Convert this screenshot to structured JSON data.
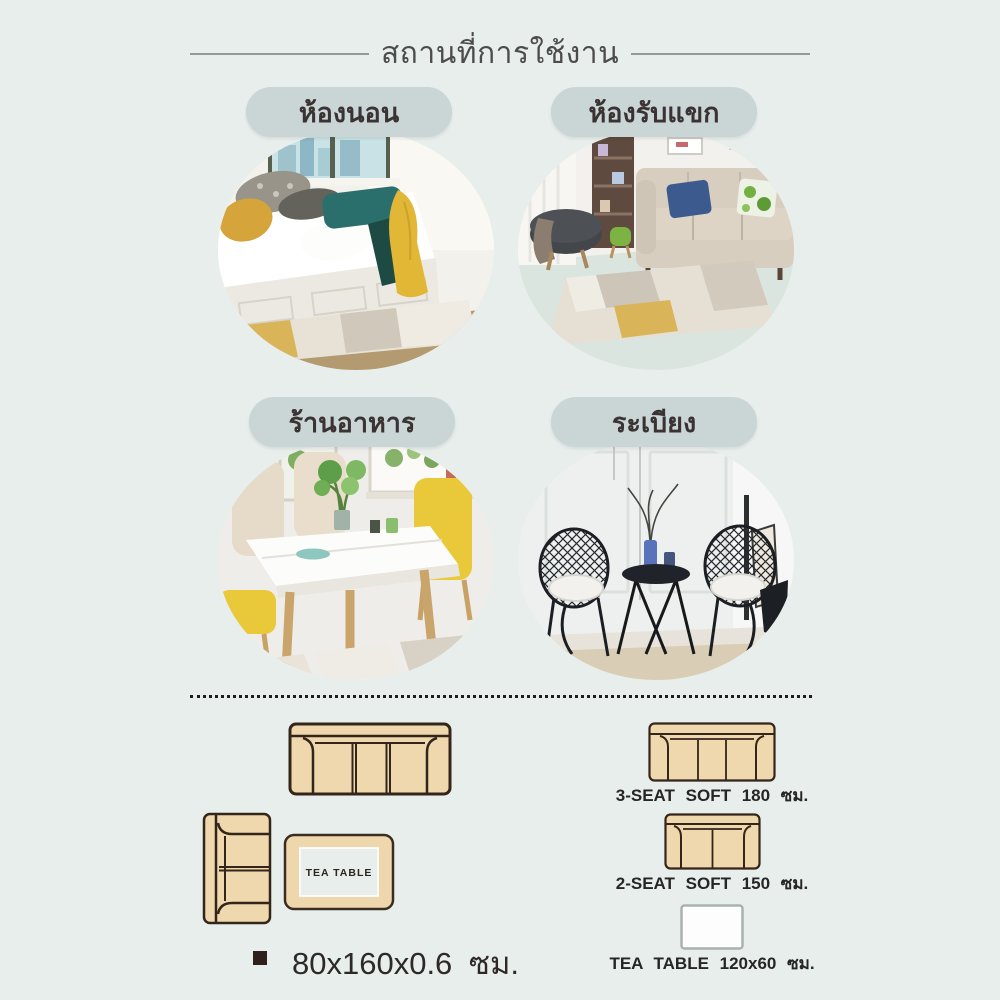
{
  "header": {
    "title": "สถานที่การใช้งาน"
  },
  "sections": [
    {
      "id": "bedroom",
      "label": "ห้องนอน"
    },
    {
      "id": "living-room",
      "label": "ห้องรับแขก"
    },
    {
      "id": "restaurant",
      "label": "ร้านอาหาร"
    },
    {
      "id": "balcony",
      "label": "ระเบียง"
    }
  ],
  "layout_diagram": {
    "tea_table_text": "TEA TABLE",
    "rug_size_text": "80x160x0.6 ซม.",
    "items": [
      {
        "label": "3-SEAT SOFT 180 ซม."
      },
      {
        "label": "2-SEAT SOFT 150 ซม."
      },
      {
        "label": "TEA TABLE 120x60 ซม."
      }
    ]
  },
  "colors": {
    "background": "#e8eeeb",
    "pill_background": "#c9d6d5",
    "diagram_fill": "#f0d8ae",
    "diagram_stroke": "#33251a"
  }
}
